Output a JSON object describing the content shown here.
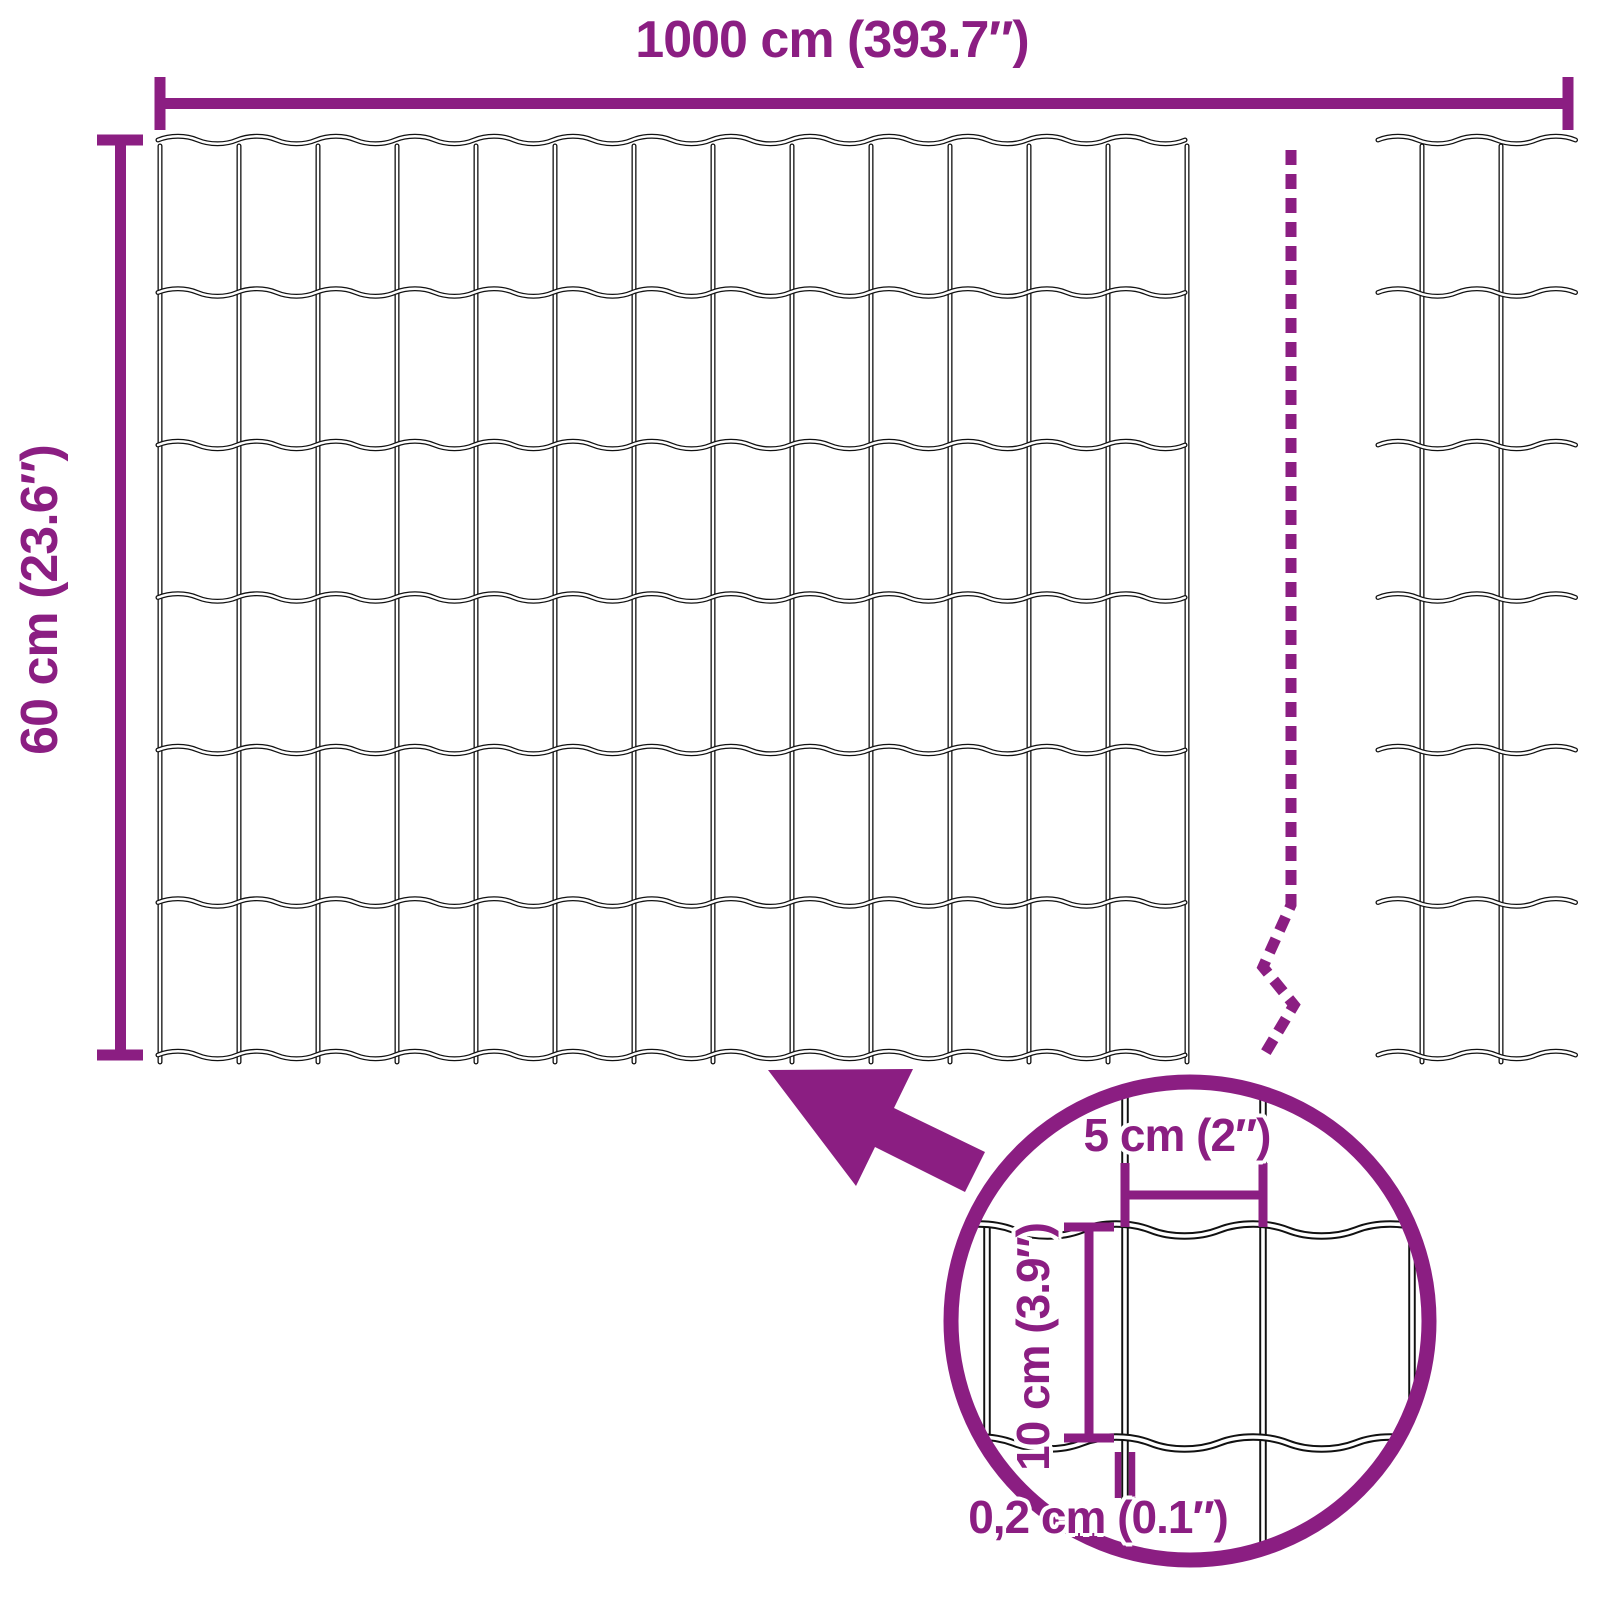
{
  "colors": {
    "accent": "#8B1E82",
    "wire": "#111111",
    "background": "#FFFFFF"
  },
  "roll": {
    "length_label": "1000 cm (393.7″)",
    "height_label": "60 cm (23.6″)"
  },
  "detail": {
    "mesh_opening_width_label": "5 cm (2″)",
    "mesh_opening_height_label": "10 cm (3.9″)",
    "wire_thickness_label": "0,2 cm (0.1″)"
  }
}
